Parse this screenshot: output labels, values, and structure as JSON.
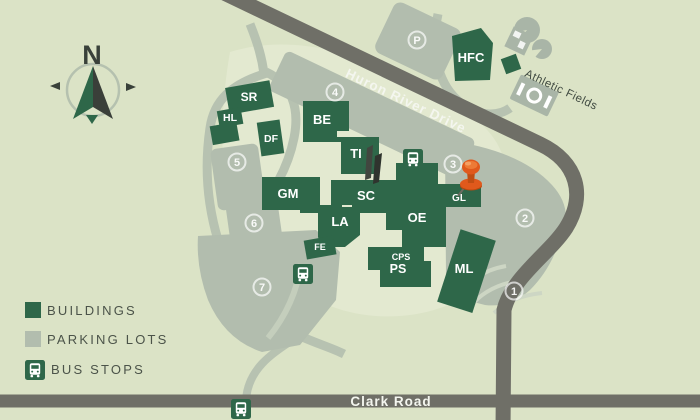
{
  "map": {
    "compass_n": "N",
    "roads": {
      "huron": "Huron River Drive",
      "clark": "Clark Road"
    },
    "buildings": [
      {
        "code": "SR"
      },
      {
        "code": "HL"
      },
      {
        "code": "DF"
      },
      {
        "code": "BE"
      },
      {
        "code": "TI"
      },
      {
        "code": "SC"
      },
      {
        "code": "GM"
      },
      {
        "code": "LA"
      },
      {
        "code": "FE"
      },
      {
        "code": "OE"
      },
      {
        "code": "GL"
      },
      {
        "code": "CPS"
      },
      {
        "code": "PS"
      },
      {
        "code": "ML"
      },
      {
        "code": "HFC"
      }
    ],
    "parking": [
      {
        "num": "P"
      },
      {
        "num": "1"
      },
      {
        "num": "2"
      },
      {
        "num": "3"
      },
      {
        "num": "4"
      },
      {
        "num": "5"
      },
      {
        "num": "6"
      },
      {
        "num": "7"
      }
    ],
    "athletic_label": "Athletic Fields",
    "marker": "pushpin-on-GL"
  },
  "legend": {
    "items": [
      {
        "label": "BUILDINGS",
        "swatch": "building-green"
      },
      {
        "label": "PARKING LOTS",
        "swatch": "parking-gray"
      },
      {
        "label": "BUS STOPS",
        "swatch": "bus-icon"
      }
    ]
  },
  "colors": {
    "background": "#dbe3c6",
    "campus_ground": "#e3e9d0",
    "building": "#2e6749",
    "parking": "#b2bdae",
    "road": "#6f6f67",
    "pin": "#e0591c"
  }
}
